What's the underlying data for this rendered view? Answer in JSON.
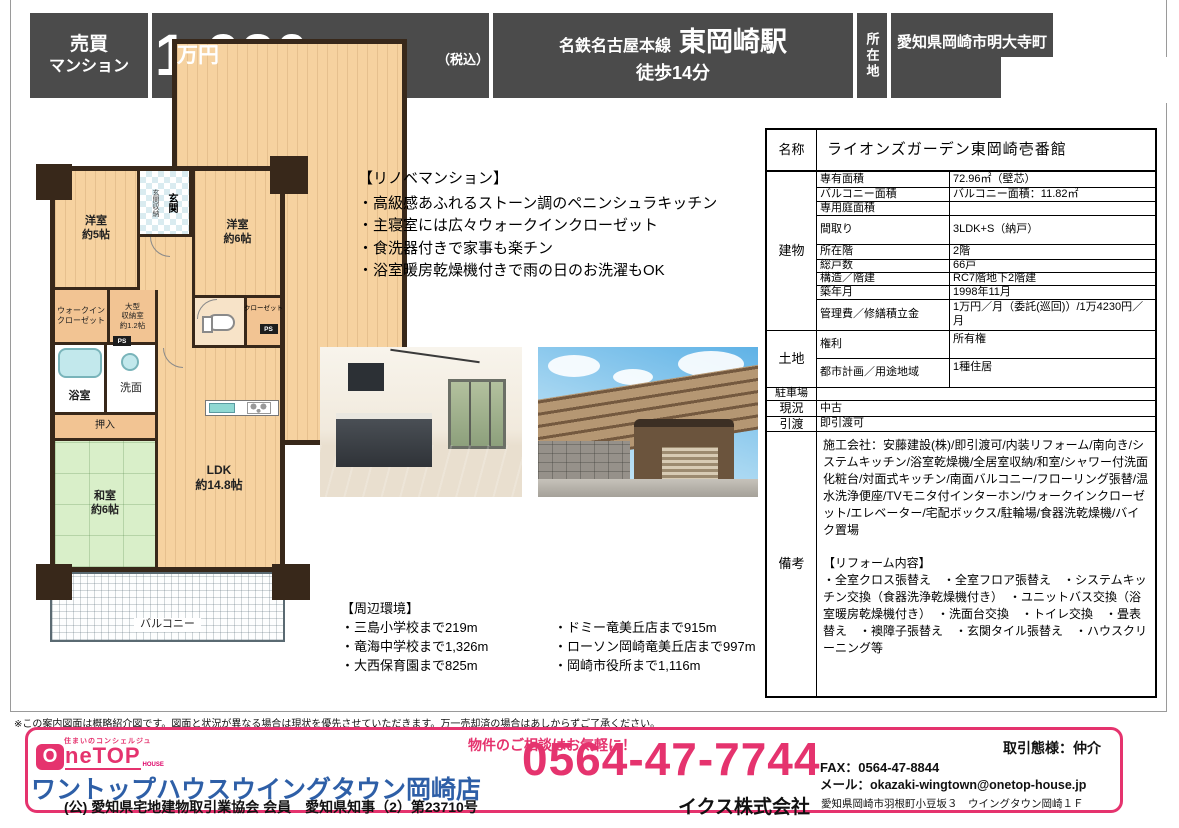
{
  "colors": {
    "accent_pink": "#e5336e",
    "header_gray": "#4b4b4b",
    "brand_blue": "#2e5fa7",
    "wall_brown": "#38281a"
  },
  "header": {
    "category": [
      "売買",
      "マンション"
    ],
    "price": {
      "value": "1,980",
      "unit": "万円",
      "tax": "（税込）"
    },
    "station": {
      "line": "名鉄名古屋本線",
      "name": "東岡崎駅",
      "walk": "徒歩14分"
    },
    "location": {
      "label": "所在地",
      "address": "愛知県岡崎市明大寺町"
    }
  },
  "floorplan": {
    "west_room_5": "洋室\n約5帖",
    "entrance_storage": "玄関収納",
    "entrance": "玄関",
    "west_room_6": "洋室\n約6帖",
    "wic": "ウォークイン\nクローゼット",
    "large_storage": "大型\n収納室\n約1.2帖",
    "closet": "クローゼット",
    "ps": "PS",
    "bath": "浴室",
    "washroom": "洗面",
    "oshiire": "押入",
    "japanese_room": "和室\n約6帖",
    "ldk": "LDK\n約14.8帖",
    "balcony": "バルコニー"
  },
  "reno": {
    "title": "【リノベマンション】",
    "items": [
      "・高級感あふれるストーン調のペニンシュラキッチン",
      "・主寝室には広々ウォークインクローゼット",
      "・食洗器付きで家事も楽チン",
      "・浴室暖房乾燥機付きで雨の日のお洗濯もOK"
    ]
  },
  "surroundings": {
    "title": "【周辺環境】",
    "left": [
      "・三島小学校まで219m",
      "・竜海中学校まで1,326m",
      "・大西保育園まで825m"
    ],
    "right": [
      "・ドミー竜美丘店まで915m",
      "・ローソン岡崎竜美丘店まで997m",
      "・岡崎市役所まで1,116m"
    ]
  },
  "table": {
    "name": {
      "label": "名称",
      "value": "ライオンズガーデン東岡崎壱番館"
    },
    "building": {
      "label": "建物",
      "rows": [
        {
          "label": "専有面積",
          "value": "72.96㎡（壁芯）"
        },
        {
          "label": "バルコニー面積",
          "value": "バルコニー面積：11.82㎡"
        },
        {
          "label": "専用庭面積",
          "value": ""
        },
        {
          "label": "間取り",
          "value": "3LDK+S（納戸）"
        },
        {
          "label": "所在階",
          "value": "2階"
        },
        {
          "label": "総戸数",
          "value": "66戸"
        },
        {
          "label": "構造／階建",
          "value": "RC7階地下2階建"
        },
        {
          "label": "築年月",
          "value": "1998年11月"
        },
        {
          "label": "管理費／修繕積立金",
          "value": "1万円／月（委託(巡回)）/1万4230円／月"
        }
      ]
    },
    "land": {
      "label": "土地",
      "rows": [
        {
          "label": "権利",
          "value": "所有権"
        },
        {
          "label": "都市計画／用途地域",
          "value": "1種住居"
        }
      ]
    },
    "parking": {
      "label": "駐車場",
      "value": ""
    },
    "status": {
      "label": "現況",
      "value": "中古"
    },
    "handover": {
      "label": "引渡",
      "value": "即引渡可"
    },
    "remarks": {
      "label": "備考",
      "features": "施工会社：安藤建設(株)/即引渡可/内装リフォーム/南向き/システムキッチン/浴室乾燥機/全居室収納/和室/シャワー付洗面化粧台/対面式キッチン/南面バルコニー/フローリング張替/温水洗浄便座/TVモニタ付インターホン/ウォークインクローゼット/エレベーター/宅配ボックス/駐輪場/食器洗乾燥機/バイク置場",
      "reform_title": "【リフォーム内容】",
      "reform": "・全室クロス張替え　・全室フロア張替え　・システムキッチン交換（食器洗浄乾燥機付き）　・ユニットバス交換（浴室暖房乾燥機付き）　・洗面台交換　・トイレ交換　・畳表替え　・襖障子張替え　・玄関タイル張替え　・ハウスクリーニング等"
    }
  },
  "disclaimer": "※この案内図面は概略紹介図です。図面と状況が異なる場合は現状を優先させていただきます。万一売却済の場合はあしからずご了承ください。",
  "footer": {
    "tagline": "住まいのコンシェルジュ",
    "logo": {
      "o": "O",
      "netop": "neTOP",
      "house": "HOUSE"
    },
    "shop_name": "ワントップハウスウイングタウン岡崎店",
    "license": "(公) 愛知県宅地建物取引業協会 会員　愛知県知事（2）第23710号",
    "cta": "物件のご相談はお気軽に！",
    "phone": "0564-47-7744",
    "company": "イクス株式会社",
    "deal_type": "取引態様：仲介",
    "fax": "FAX：0564-47-8844",
    "mail": "メール：okazaki-wingtown@onetop-house.jp",
    "address": "愛知県岡崎市羽根町小豆坂３　ウイングタウン岡崎１Ｆ"
  }
}
